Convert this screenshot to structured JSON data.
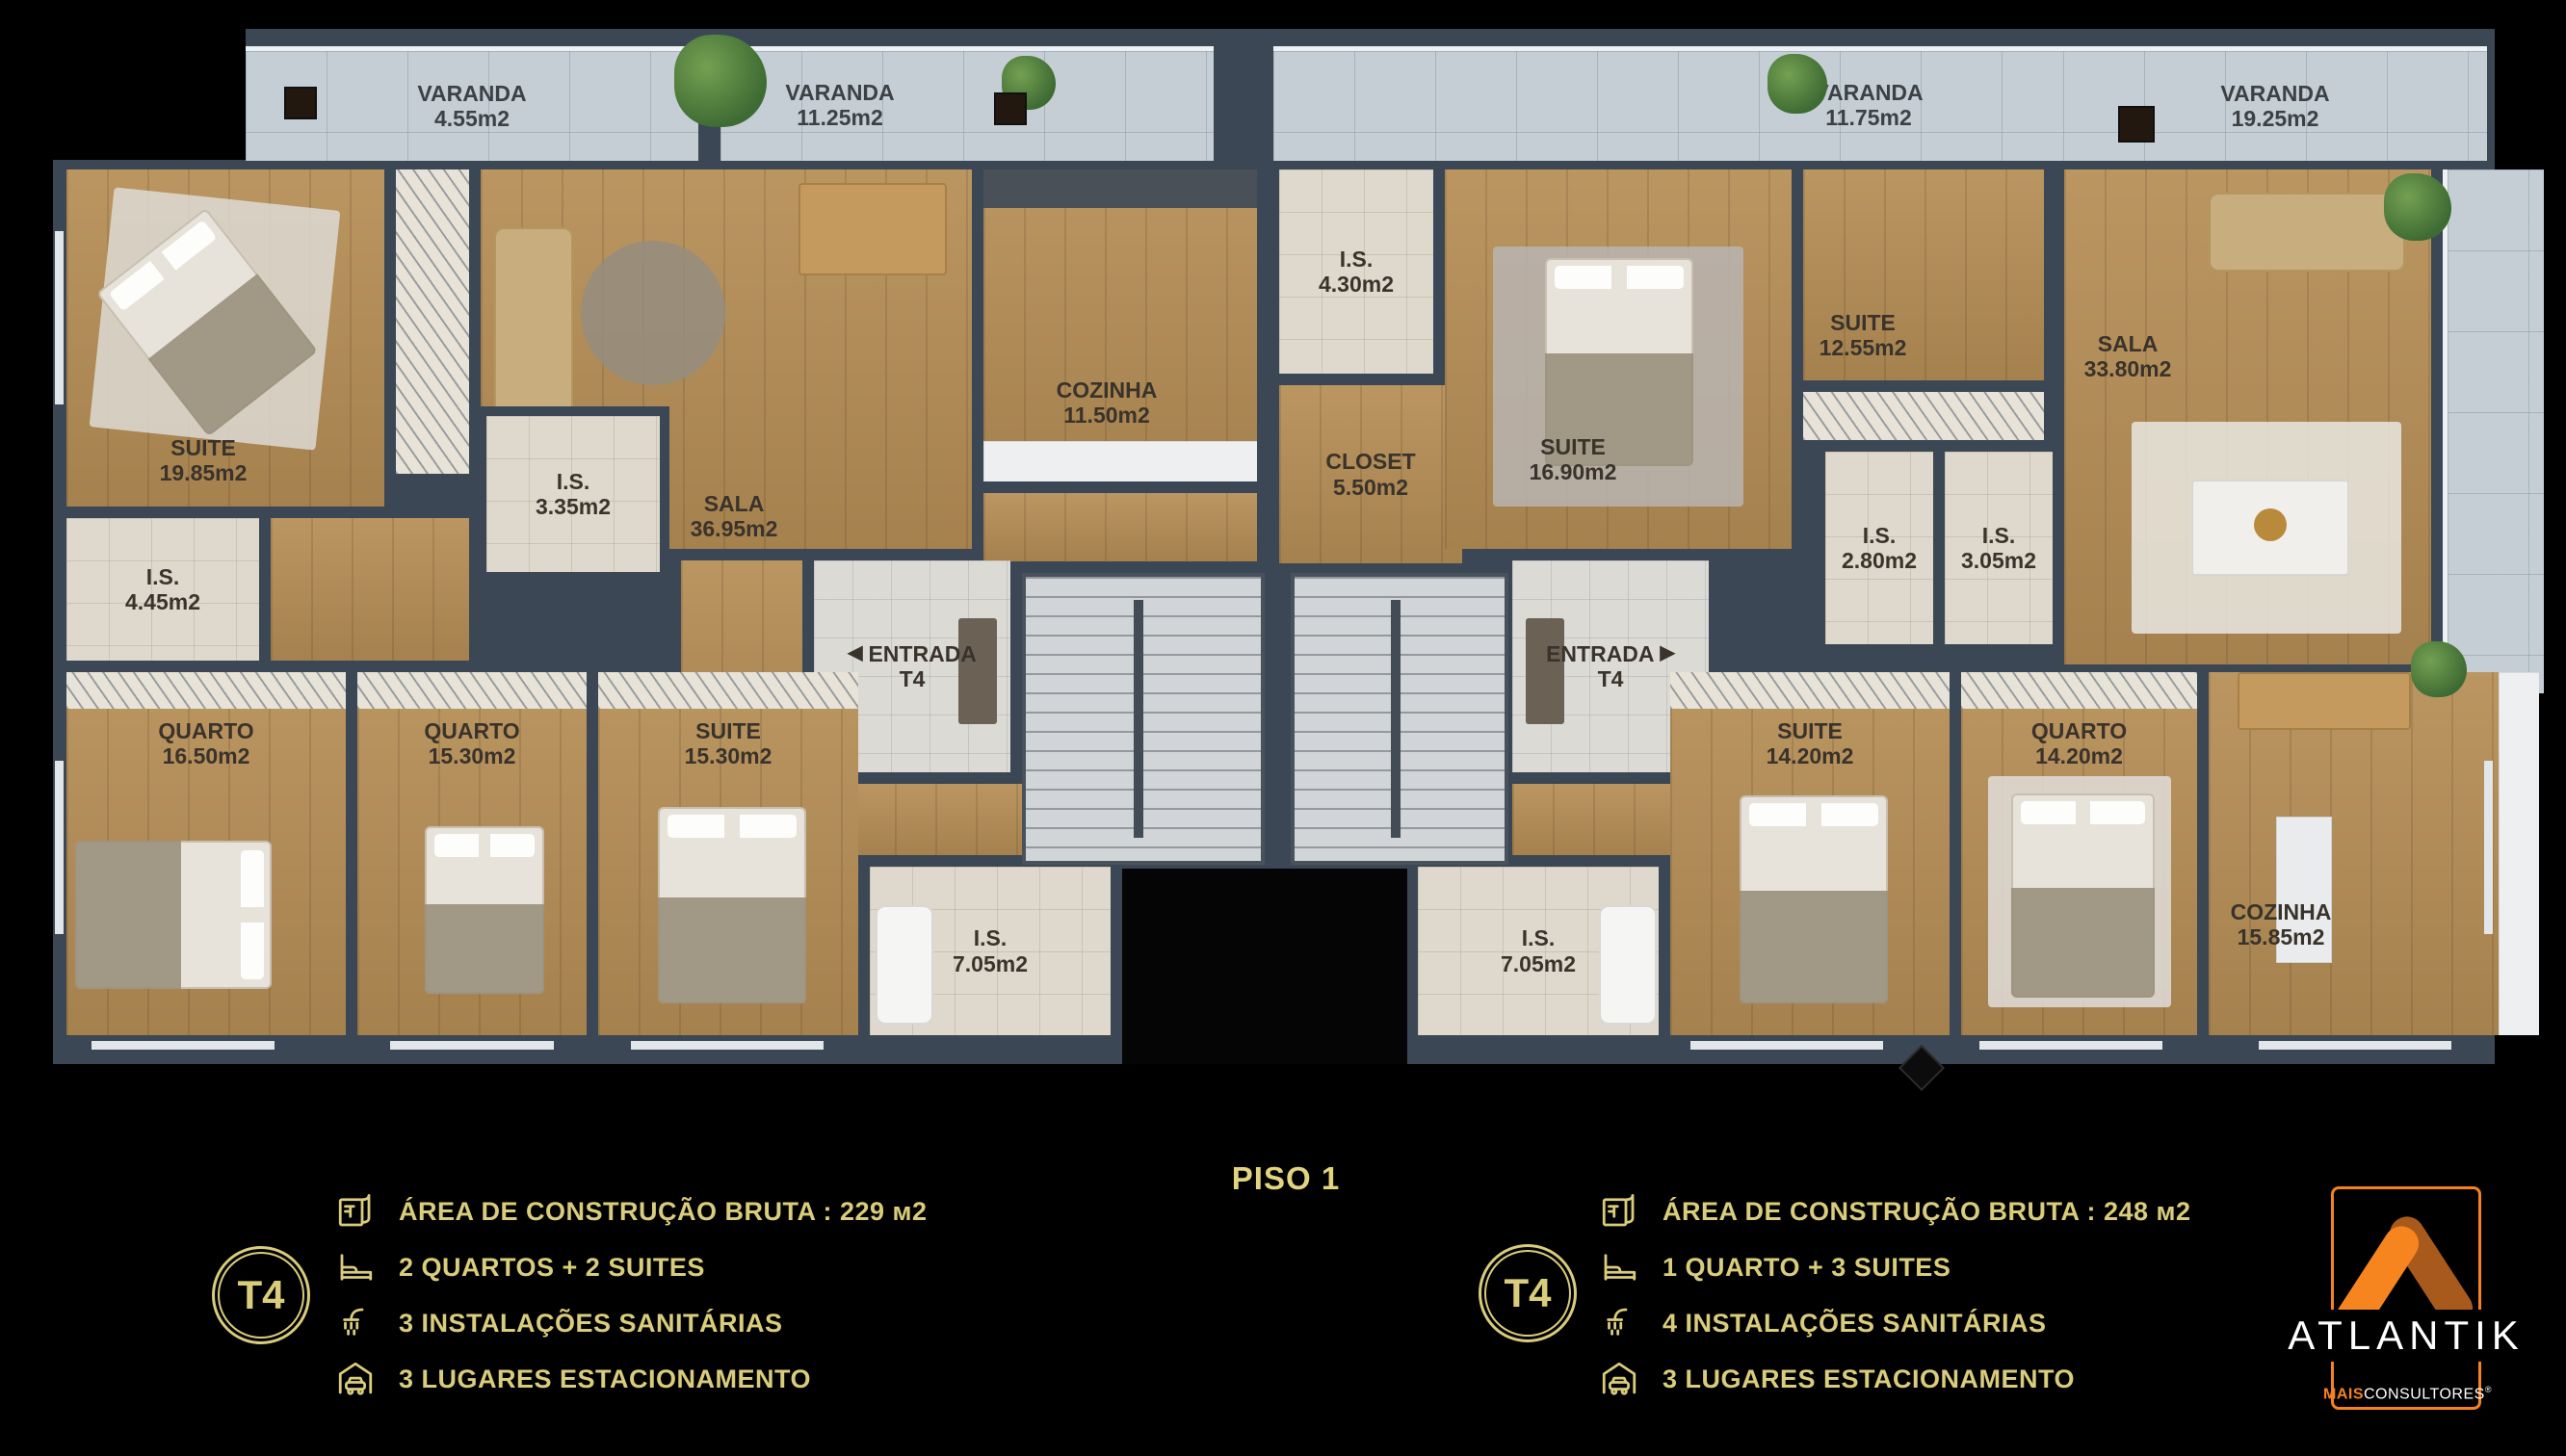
{
  "floor": {
    "label": "PISO 1"
  },
  "rooms_left": [
    {
      "label": "VARANDA",
      "area": "4.55m2"
    },
    {
      "label": "VARANDA",
      "area": "11.25m2"
    },
    {
      "label": "SUITE",
      "area": "19.85m2"
    },
    {
      "label": "I.S.",
      "area": "4.45m2"
    },
    {
      "label": "I.S.",
      "area": "3.35m2"
    },
    {
      "label": "SALA",
      "area": "36.95m2"
    },
    {
      "label": "COZINHA",
      "area": "11.50m2"
    },
    {
      "label": "ENTRADA",
      "area": "T4",
      "arrow": "◀"
    },
    {
      "label": "QUARTO",
      "area": "16.50m2"
    },
    {
      "label": "QUARTO",
      "area": "15.30m2"
    },
    {
      "label": "SUITE",
      "area": "15.30m2"
    },
    {
      "label": "I.S.",
      "area": "7.05m2"
    }
  ],
  "rooms_right": [
    {
      "label": "VARANDA",
      "area": "11.75m2"
    },
    {
      "label": "VARANDA",
      "area": "19.25m2"
    },
    {
      "label": "I.S.",
      "area": "4.30m2"
    },
    {
      "label": "CLOSET",
      "area": "5.50m2"
    },
    {
      "label": "SUITE",
      "area": "16.90m2"
    },
    {
      "label": "SUITE",
      "area": "12.55m2"
    },
    {
      "label": "I.S.",
      "area": "2.80m2"
    },
    {
      "label": "I.S.",
      "area": "3.05m2"
    },
    {
      "label": "SALA",
      "area": "33.80m2"
    },
    {
      "label": "ENTRADA",
      "area": "T4",
      "arrow": "▶"
    },
    {
      "label": "I.S.",
      "area": "7.05m2"
    },
    {
      "label": "SUITE",
      "area": "14.20m2"
    },
    {
      "label": "QUARTO",
      "area": "14.20m2"
    },
    {
      "label": "COZINHA",
      "area": "15.85m2"
    }
  ],
  "legend_left": {
    "badge": "T4",
    "items": [
      {
        "icon": "blueprint-icon",
        "text": "ÁREA DE CONSTRUÇÃO BRUTA :  229 м2"
      },
      {
        "icon": "bed-icon",
        "text": "2 QUARTOS + 2 SUITES"
      },
      {
        "icon": "shower-icon",
        "text": "3 INSTALAÇÕES SANITÁRIAS"
      },
      {
        "icon": "garage-icon",
        "text": "3 LUGARES ESTACIONAMENTO"
      }
    ]
  },
  "legend_right": {
    "badge": "T4",
    "items": [
      {
        "icon": "blueprint-icon",
        "text": "ÁREA DE CONSTRUÇÃO BRUTA :  248 м2"
      },
      {
        "icon": "bed-icon",
        "text": "1 QUARTO + 3 SUITES"
      },
      {
        "icon": "shower-icon",
        "text": "4 INSTALAÇÕES SANITÁRIAS"
      },
      {
        "icon": "garage-icon",
        "text": "3 LUGARES ESTACIONAMENTO"
      }
    ]
  },
  "logo": {
    "brand": "ATLANTIK",
    "sub_bold": "MAIS",
    "sub_rest": "CONSULTORES",
    "registered": "®"
  },
  "colors": {
    "legend_gold": "#D9CC7C",
    "logo_orange": "#F58220",
    "logo_orange_dark": "#A85A1C",
    "wall_slate": "#3B4754"
  }
}
